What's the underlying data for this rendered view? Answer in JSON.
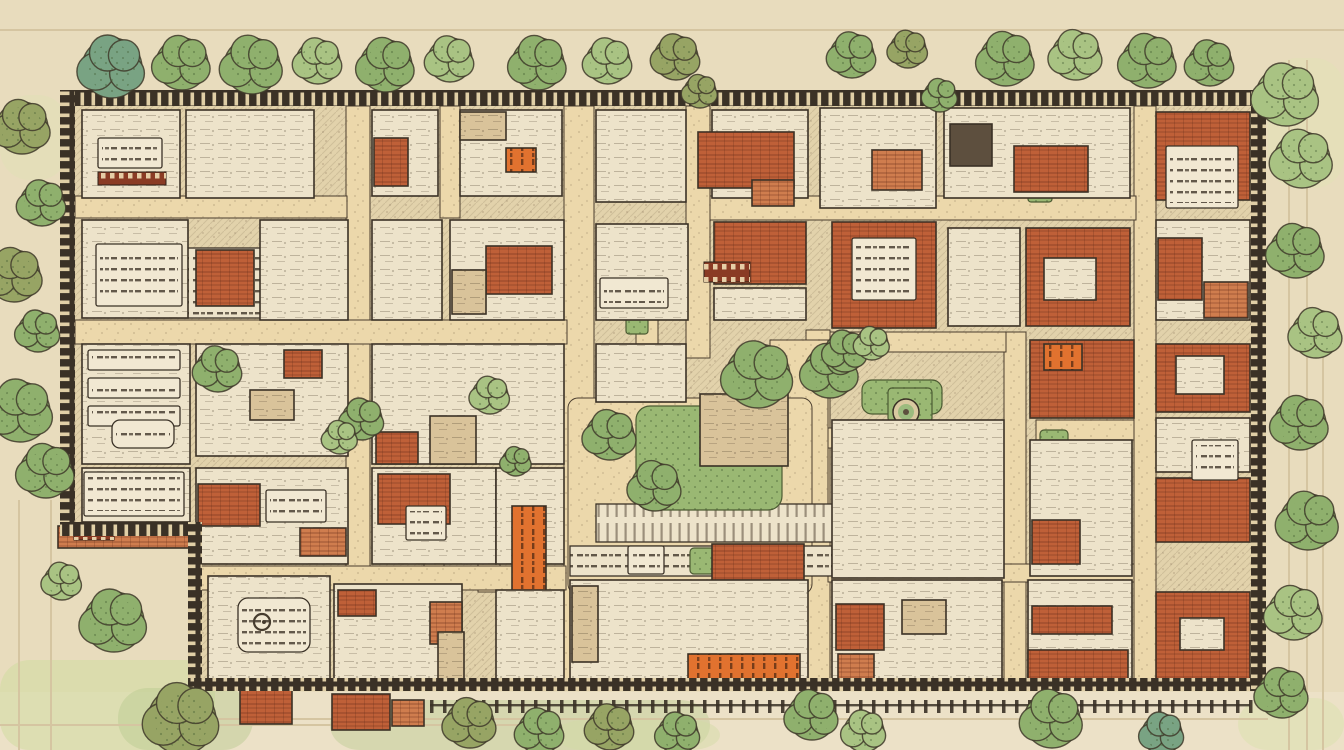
{
  "meta": {
    "title": "Hand-drawn walled town site plan",
    "text_legibility": "all lettering on the plan is illegible decorative scribble",
    "canvas": {
      "w": 1344,
      "h": 750
    }
  },
  "palette": {
    "parchment": "#e8dcbd",
    "parchment2": "#ece2c9",
    "road": "#ecd8ab",
    "roadEdge": "#4a3d2e",
    "plan": "#ede3ca",
    "planEdge": "#3a3126",
    "roof": "#bf6038",
    "roofLight": "#cf7d4e",
    "accent": "#e1722f",
    "tan": "#d9c39a",
    "dark": "#5d4f3e",
    "lawn": "#9ab873",
    "pool": "#9cbb7e",
    "treeGreen": "#8fb06d",
    "treeLight": "#a9c383",
    "treeTeal": "#79a383",
    "treeOlive": "#97a464",
    "treeStroke": "#3f3a2a",
    "wall": "#3a3126",
    "wallTick": "#e0cfa6",
    "labelRed": "#8a3b24",
    "labelGlyph": "#ecddb5",
    "faint": "#d5c5a1",
    "plaque": "#f1e8d2",
    "scribble": "#463c2e"
  },
  "washes": [
    [
      0,
      660,
      215,
      90,
      "#cddb9e",
      0.5
    ],
    [
      118,
      688,
      135,
      62,
      "#b9c98e",
      0.45
    ],
    [
      330,
      700,
      380,
      50,
      "#b7c88c",
      0.4
    ],
    [
      555,
      720,
      165,
      30,
      "#d2dca4",
      0.45
    ],
    [
      1238,
      698,
      106,
      52,
      "#d6e0a8",
      0.4
    ],
    [
      1268,
      58,
      76,
      130,
      "#dfe6b2",
      0.35
    ],
    [
      0,
      95,
      68,
      85,
      "#dbe3ae",
      0.3
    ]
  ],
  "faint_lines": {
    "h": [
      [
        0,
        29,
        1344
      ],
      [
        0,
        724,
        560
      ],
      [
        180,
        718,
        1088
      ]
    ],
    "v": [
      [
        18,
        500,
        250
      ],
      [
        50,
        500,
        250
      ],
      [
        1288,
        60,
        690
      ],
      [
        1306,
        60,
        690
      ],
      [
        1322,
        330,
        420
      ]
    ]
  },
  "interior_polygon": "60,90 1266,90 1266,691 202,691 202,536 60,536",
  "roads": [
    [
      346,
      106,
      24,
      462
    ],
    [
      564,
      106,
      30,
      584
    ],
    [
      686,
      106,
      24,
      252
    ],
    [
      806,
      330,
      24,
      360
    ],
    [
      1004,
      332,
      22,
      358
    ],
    [
      1134,
      106,
      22,
      584
    ],
    [
      950,
      564,
      20,
      116
    ],
    [
      440,
      106,
      20,
      112
    ],
    [
      636,
      254,
      22,
      152
    ],
    [
      424,
      468,
      20,
      100
    ],
    [
      478,
      468,
      22,
      124
    ],
    [
      75,
      196,
      272,
      22
    ],
    [
      75,
      320,
      492,
      24
    ],
    [
      710,
      196,
      426,
      24
    ],
    [
      830,
      332,
      176,
      20
    ],
    [
      1036,
      420,
      98,
      20
    ],
    [
      828,
      428,
      130,
      20
    ],
    [
      200,
      566,
      366,
      24
    ],
    [
      828,
      564,
      306,
      18
    ],
    [
      770,
      340,
      58,
      170
    ]
  ],
  "plaza": [
    568,
    398,
    244,
    196,
    10
  ],
  "bands": [
    {
      "r": [
        596,
        504,
        238,
        38
      ],
      "kind": "colonnade"
    },
    {
      "r": [
        570,
        546,
        262,
        30
      ],
      "kind": "inscription"
    },
    {
      "r": [
        100,
        375,
        86,
        30
      ],
      "kind": "colonnade"
    },
    {
      "r": [
        148,
        248,
        196,
        70
      ],
      "kind": "inscription"
    }
  ],
  "greens": [
    [
      636,
      406,
      146,
      104,
      14
    ],
    [
      632,
      368,
      30,
      34,
      4
    ],
    [
      602,
      596,
      122,
      62,
      6
    ],
    [
      146,
      132,
      32,
      62,
      3
    ],
    [
      862,
      380,
      80,
      34,
      10
    ],
    [
      888,
      388,
      44,
      34,
      4
    ],
    [
      1028,
      166,
      24,
      36,
      3
    ],
    [
      626,
      306,
      22,
      28,
      3
    ],
    [
      690,
      548,
      38,
      26,
      4
    ],
    [
      514,
      478,
      34,
      28,
      4
    ],
    [
      1040,
      430,
      28,
      24,
      4
    ]
  ],
  "pond": {
    "cx": 906,
    "cy": 412,
    "r_outer": 13,
    "r_mid": 8,
    "r_core": 3
  },
  "buildings": [
    [
      82,
      110,
      98,
      88,
      "plan"
    ],
    [
      186,
      110,
      128,
      88,
      "plan"
    ],
    [
      372,
      110,
      66,
      86,
      "plan"
    ],
    [
      374,
      138,
      34,
      48,
      "roof"
    ],
    [
      460,
      110,
      102,
      86,
      "plan"
    ],
    [
      460,
      112,
      46,
      28,
      "tan"
    ],
    [
      506,
      148,
      30,
      24,
      "accent"
    ],
    [
      596,
      110,
      90,
      92,
      "plan"
    ],
    [
      712,
      110,
      96,
      88,
      "plan"
    ],
    [
      698,
      132,
      96,
      56,
      "roof"
    ],
    [
      752,
      180,
      42,
      26,
      "roofL"
    ],
    [
      820,
      108,
      116,
      100,
      "plan"
    ],
    [
      872,
      150,
      50,
      40,
      "roofL"
    ],
    [
      944,
      108,
      186,
      90,
      "plan"
    ],
    [
      950,
      124,
      42,
      42,
      "dark"
    ],
    [
      1014,
      146,
      74,
      46,
      "roof"
    ],
    [
      1156,
      112,
      94,
      88,
      "roof"
    ],
    [
      82,
      220,
      106,
      98,
      "plan"
    ],
    [
      196,
      250,
      58,
      56,
      "roof"
    ],
    [
      260,
      220,
      88,
      100,
      "plan"
    ],
    [
      372,
      220,
      70,
      100,
      "plan"
    ],
    [
      450,
      220,
      114,
      100,
      "plan"
    ],
    [
      486,
      246,
      66,
      48,
      "roof"
    ],
    [
      452,
      270,
      34,
      44,
      "tan"
    ],
    [
      596,
      224,
      92,
      96,
      "plan"
    ],
    [
      714,
      222,
      92,
      62,
      "roof"
    ],
    [
      714,
      288,
      92,
      32,
      "plan"
    ],
    [
      832,
      222,
      104,
      106,
      "roof"
    ],
    [
      948,
      228,
      72,
      98,
      "plan"
    ],
    [
      1026,
      228,
      104,
      98,
      "roof"
    ],
    [
      1044,
      258,
      52,
      42,
      "plan"
    ],
    [
      1156,
      220,
      94,
      100,
      "plan"
    ],
    [
      1158,
      238,
      44,
      62,
      "roof"
    ],
    [
      1204,
      282,
      44,
      36,
      "roofL"
    ],
    [
      82,
      344,
      108,
      120,
      "plan"
    ],
    [
      196,
      344,
      152,
      112,
      "plan"
    ],
    [
      284,
      350,
      38,
      28,
      "roof"
    ],
    [
      250,
      390,
      44,
      30,
      "tan"
    ],
    [
      372,
      344,
      192,
      120,
      "plan"
    ],
    [
      430,
      416,
      46,
      48,
      "tan"
    ],
    [
      376,
      432,
      42,
      32,
      "roof"
    ],
    [
      596,
      344,
      90,
      58,
      "plan"
    ],
    [
      700,
      394,
      88,
      72,
      "tan"
    ],
    [
      832,
      420,
      172,
      158,
      "plan"
    ],
    [
      1030,
      340,
      104,
      78,
      "roof"
    ],
    [
      1044,
      344,
      38,
      26,
      "accent"
    ],
    [
      1030,
      440,
      102,
      136,
      "plan"
    ],
    [
      1032,
      520,
      48,
      44,
      "roof"
    ],
    [
      1156,
      344,
      94,
      68,
      "roof"
    ],
    [
      1176,
      356,
      48,
      38,
      "plan"
    ],
    [
      1156,
      418,
      94,
      54,
      "plan"
    ],
    [
      1156,
      478,
      94,
      64,
      "roof"
    ],
    [
      82,
      468,
      108,
      54,
      "plan"
    ],
    [
      58,
      526,
      136,
      22,
      "roofL"
    ],
    [
      196,
      468,
      152,
      96,
      "plan"
    ],
    [
      198,
      484,
      62,
      42,
      "roof"
    ],
    [
      300,
      528,
      46,
      28,
      "roofL"
    ],
    [
      372,
      468,
      124,
      96,
      "plan"
    ],
    [
      378,
      474,
      72,
      50,
      "roof"
    ],
    [
      496,
      468,
      68,
      96,
      "plan"
    ],
    [
      512,
      506,
      34,
      86,
      "accent"
    ],
    [
      712,
      544,
      92,
      38,
      "roof"
    ],
    [
      208,
      576,
      122,
      112,
      "plan"
    ],
    [
      334,
      584,
      128,
      104,
      "plan"
    ],
    [
      338,
      590,
      38,
      26,
      "roof"
    ],
    [
      430,
      602,
      32,
      42,
      "roofL"
    ],
    [
      438,
      632,
      26,
      48,
      "tan"
    ],
    [
      496,
      590,
      68,
      98,
      "plan"
    ],
    [
      570,
      580,
      238,
      108,
      "plan"
    ],
    [
      572,
      586,
      26,
      76,
      "tan"
    ],
    [
      688,
      654,
      112,
      32,
      "accent"
    ],
    [
      832,
      580,
      170,
      108,
      "plan"
    ],
    [
      836,
      604,
      48,
      46,
      "roof"
    ],
    [
      838,
      654,
      36,
      26,
      "roofL"
    ],
    [
      902,
      600,
      44,
      34,
      "tan"
    ],
    [
      1028,
      580,
      104,
      108,
      "plan"
    ],
    [
      1032,
      606,
      80,
      28,
      "roof"
    ],
    [
      1028,
      650,
      100,
      30,
      "roof"
    ],
    [
      1156,
      592,
      94,
      96,
      "roof"
    ],
    [
      1180,
      618,
      44,
      32,
      "plan"
    ],
    [
      240,
      690,
      52,
      34,
      "roof"
    ],
    [
      332,
      694,
      58,
      36,
      "roof"
    ],
    [
      392,
      700,
      32,
      26,
      "roofL"
    ]
  ],
  "plaques": [
    [
      98,
      138,
      64,
      30,
      2
    ],
    [
      96,
      244,
      86,
      62,
      2
    ],
    [
      88,
      350,
      92,
      20,
      2
    ],
    [
      88,
      378,
      92,
      20,
      2
    ],
    [
      88,
      406,
      92,
      20,
      2
    ],
    [
      112,
      420,
      62,
      28,
      8
    ],
    [
      600,
      278,
      68,
      30,
      2
    ],
    [
      852,
      238,
      64,
      62,
      2
    ],
    [
      266,
      490,
      60,
      32,
      2
    ],
    [
      406,
      506,
      40,
      34,
      2
    ],
    [
      238,
      598,
      72,
      54,
      10
    ],
    [
      1192,
      440,
      46,
      40,
      2
    ],
    [
      1166,
      146,
      72,
      62,
      2
    ],
    [
      628,
      546,
      36,
      28,
      2
    ],
    [
      84,
      472,
      100,
      44,
      2
    ]
  ],
  "labels": [
    [
      98,
      172,
      68,
      13
    ],
    [
      704,
      262,
      46,
      20
    ],
    [
      74,
      528,
      40,
      12
    ]
  ],
  "emblem": {
    "cx": 262,
    "cy": 622,
    "r": 8
  },
  "walls": [
    [
      60,
      90,
      1206,
      16,
      "h"
    ],
    [
      60,
      90,
      15,
      446,
      "v"
    ],
    [
      60,
      522,
      142,
      14,
      "h"
    ],
    [
      188,
      522,
      14,
      170,
      "v"
    ],
    [
      188,
      678,
      1078,
      13,
      "h"
    ],
    [
      1251,
      90,
      15,
      601,
      "v"
    ]
  ],
  "fence": {
    "x1": 430,
    "x2": 1250,
    "y": 700,
    "post_w": 3.5,
    "post_h": 13,
    "spacing": 13
  },
  "trees": [
    [
      112,
      68,
      30,
      "teal"
    ],
    [
      182,
      64,
      26,
      "green"
    ],
    [
      252,
      66,
      28,
      "green"
    ],
    [
      318,
      62,
      22,
      "light"
    ],
    [
      386,
      66,
      26,
      "green"
    ],
    [
      450,
      60,
      22,
      "light"
    ],
    [
      538,
      64,
      26,
      "green"
    ],
    [
      608,
      62,
      22,
      "light"
    ],
    [
      676,
      58,
      22,
      "olive"
    ],
    [
      700,
      92,
      16,
      "olive"
    ],
    [
      852,
      56,
      22,
      "green"
    ],
    [
      908,
      50,
      18,
      "olive"
    ],
    [
      940,
      96,
      16,
      "green"
    ],
    [
      1006,
      60,
      26,
      "green"
    ],
    [
      1076,
      56,
      24,
      "light"
    ],
    [
      1148,
      62,
      26,
      "green"
    ],
    [
      1210,
      64,
      22,
      "green"
    ],
    [
      1286,
      96,
      30,
      "light"
    ],
    [
      1302,
      160,
      28,
      "light"
    ],
    [
      1296,
      252,
      26,
      "green"
    ],
    [
      1316,
      334,
      24,
      "light"
    ],
    [
      1300,
      424,
      26,
      "green"
    ],
    [
      1308,
      522,
      28,
      "green"
    ],
    [
      1294,
      614,
      26,
      "light"
    ],
    [
      1282,
      694,
      24,
      "green"
    ],
    [
      22,
      128,
      26,
      "olive"
    ],
    [
      42,
      204,
      22,
      "green"
    ],
    [
      14,
      276,
      26,
      "olive"
    ],
    [
      38,
      332,
      20,
      "green"
    ],
    [
      20,
      412,
      30,
      "green"
    ],
    [
      46,
      472,
      26,
      "green"
    ],
    [
      62,
      582,
      18,
      "light"
    ],
    [
      114,
      622,
      30,
      "green"
    ],
    [
      182,
      720,
      34,
      "olive"
    ],
    [
      470,
      724,
      24,
      "olive"
    ],
    [
      540,
      732,
      22,
      "green"
    ],
    [
      610,
      728,
      22,
      "olive"
    ],
    [
      678,
      734,
      20,
      "green"
    ],
    [
      812,
      716,
      24,
      "green"
    ],
    [
      864,
      732,
      20,
      "light"
    ],
    [
      1052,
      720,
      28,
      "green"
    ],
    [
      1162,
      734,
      20,
      "teal"
    ],
    [
      218,
      370,
      22,
      "green"
    ],
    [
      362,
      420,
      20,
      "green"
    ],
    [
      340,
      438,
      16,
      "light"
    ],
    [
      490,
      396,
      18,
      "light"
    ],
    [
      516,
      462,
      14,
      "green"
    ],
    [
      610,
      436,
      24,
      "green"
    ],
    [
      655,
      487,
      24,
      "green"
    ],
    [
      758,
      376,
      32,
      "green"
    ],
    [
      830,
      372,
      26,
      "green"
    ],
    [
      845,
      352,
      20,
      "green"
    ],
    [
      872,
      344,
      16,
      "light"
    ]
  ]
}
